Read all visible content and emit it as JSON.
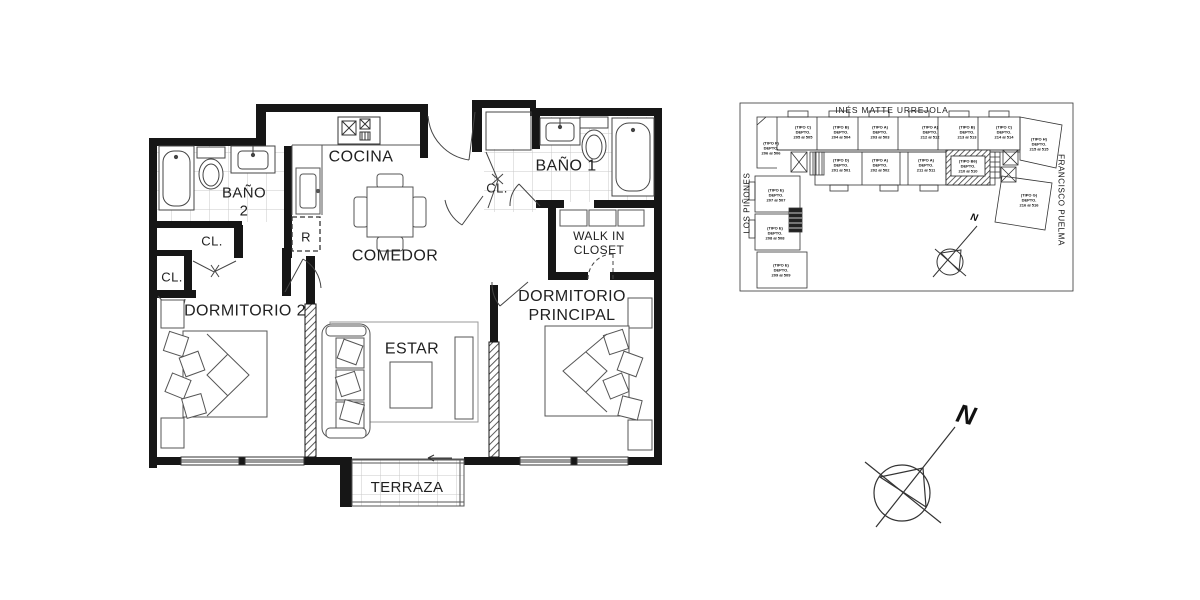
{
  "floor_plan": {
    "rooms": {
      "cocina": "COCINA",
      "comedor": "COMEDOR",
      "estar": "ESTAR",
      "terraza": "TERRAZA",
      "bano2_line1": "BAÑO",
      "bano2_line2": "2",
      "bano1": "BAÑO 1",
      "dormitorio2": "DORMITORIO 2",
      "principal_line1": "DORMITORIO",
      "principal_line2": "PRINCIPAL",
      "walkin_line1": "WALK IN",
      "walkin_line2": "CLOSET",
      "closet": "CL.",
      "refrigerator": "R"
    }
  },
  "site_plan": {
    "title": "INÉS MATTE URREJOLA",
    "street_left": "LOS PIÑONES",
    "street_right": "FRANCISCO PUELMA",
    "compass_north": "N",
    "units": [
      {
        "type": "(TIPO C)",
        "depto": "DEPTO.",
        "range": "205 al 505"
      },
      {
        "type": "(TIPO B)",
        "depto": "DEPTO.",
        "range": "204 al 504"
      },
      {
        "type": "(TIPO A)",
        "depto": "DEPTO.",
        "range": "203 al 503"
      },
      {
        "type": "(TIPO A)",
        "depto": "DEPTO.",
        "range": "212 al 512"
      },
      {
        "type": "(TIPO B)",
        "depto": "DEPTO.",
        "range": "213 al 513"
      },
      {
        "type": "(TIPO C)",
        "depto": "DEPTO.",
        "range": "214 al 514"
      },
      {
        "type": "(TIPO H)",
        "depto": "DEPTO.",
        "range": "215 al 515"
      },
      {
        "type": "(TIPO F)",
        "depto": "DEPTO.",
        "range": "206 al 506"
      },
      {
        "type": "(TIPO D)",
        "depto": "DEPTO.",
        "range": "201 al 501"
      },
      {
        "type": "(TIPO A)",
        "depto": "DEPTO.",
        "range": "202 al 502"
      },
      {
        "type": "(TIPO A)",
        "depto": "DEPTO.",
        "range": "211 al 511"
      },
      {
        "type": "(TIPO B6)",
        "depto": "DEPTO.",
        "range": "210 al 510"
      },
      {
        "type": "(TIPO G)",
        "depto": "DEPTO.",
        "range": "216 al 516"
      },
      {
        "type": "(TIPO E)",
        "depto": "DEPTO.",
        "range": "207 al 507"
      },
      {
        "type": "(TIPO E)",
        "depto": "DEPTO.",
        "range": "208 al 508"
      },
      {
        "type": "(TIPO E)",
        "depto": "DEPTO.",
        "range": "209 al 509"
      }
    ]
  },
  "compass": {
    "north": "N"
  }
}
